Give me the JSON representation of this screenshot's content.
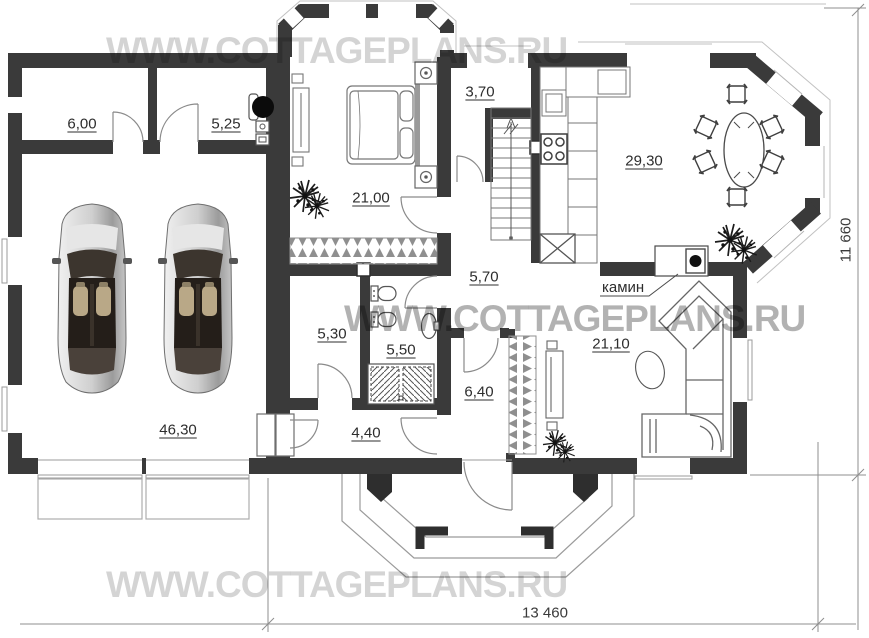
{
  "watermarks": {
    "top": "WWW.COTTAGEPLANS.RU",
    "middle": "WWW.COTTAGEPLANS.RU",
    "bottom": "WWW.COTTAGEPLANS.RU"
  },
  "rooms": {
    "storage": {
      "label": "6,00"
    },
    "boiler_room": {
      "label": "5,25"
    },
    "bedroom": {
      "label": "21,00"
    },
    "stair_hall": {
      "label": "3,70"
    },
    "kitchen_dining": {
      "label": "29,30"
    },
    "hall": {
      "label": "5,70"
    },
    "dressing": {
      "label": "5,30"
    },
    "bathroom": {
      "label": "5,50"
    },
    "entry_hall": {
      "label": "6,40"
    },
    "living_room": {
      "label": "21,10"
    },
    "garage": {
      "label": "46,30"
    },
    "vestibule": {
      "label": "4,40"
    }
  },
  "annotations": {
    "fireplace": "камин"
  },
  "dimensions": {
    "overall_width": "13 460",
    "overall_height": "11 660"
  },
  "colors": {
    "wall": "#3a3a3a",
    "thin_line": "#8f8f8f",
    "watermark": "#c9c9c9"
  }
}
